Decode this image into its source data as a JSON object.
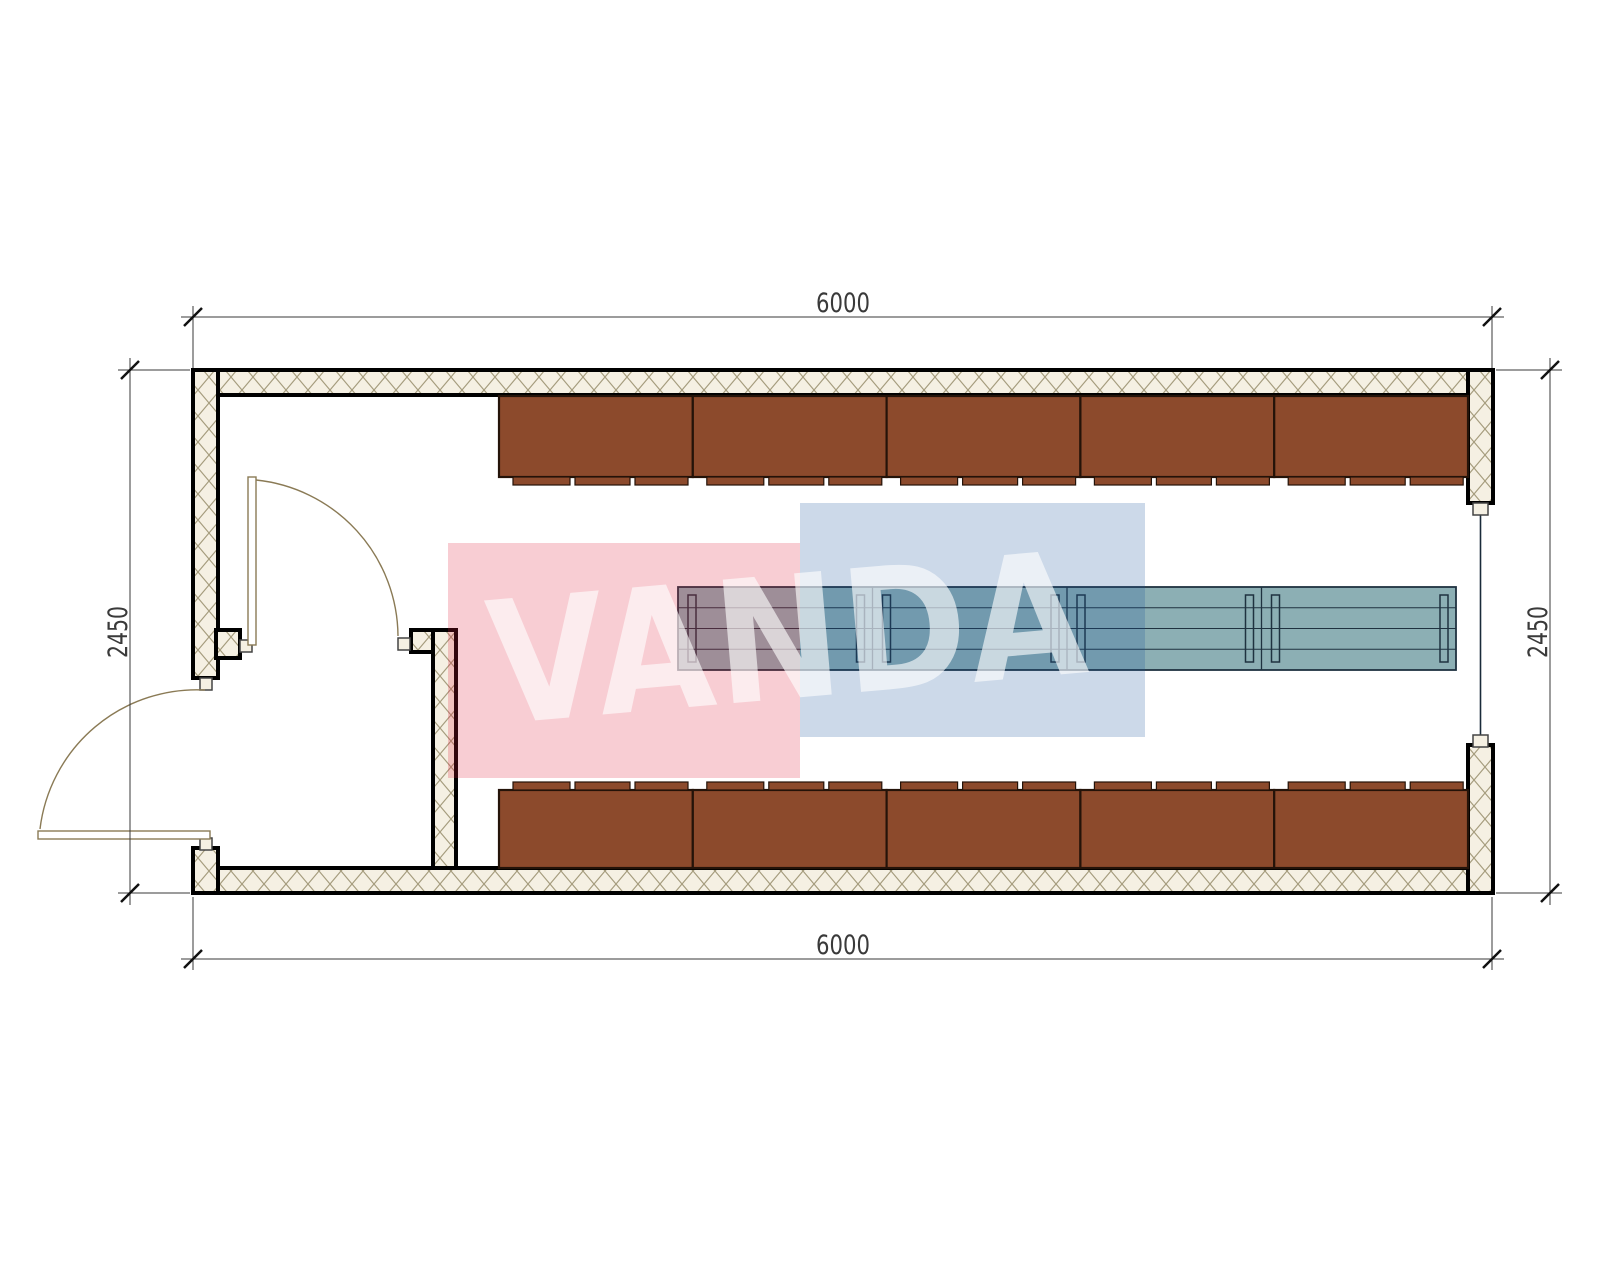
{
  "floor_plan": {
    "dimensions": {
      "top": "6000",
      "bottom": "6000",
      "left": "2450",
      "right": "2450"
    },
    "watermark": {
      "text": "VANDA",
      "red_block_color": "#df1c37",
      "blue_block_color": "#17529b",
      "text_color": "#ffffff"
    },
    "colors": {
      "cabinet_fill": "#8c4a2c",
      "table_fill": "#8cafb4",
      "table_line": "#1f3240",
      "wall_hatch_bg": "#f5f0e3",
      "wall_hatch_line": "#a59c7d",
      "door_line": "#8a7a55",
      "dimension_line": "#3a3a3a",
      "frame_square_fill": "#f5f0e3"
    },
    "counts": {
      "wall_cabinets_top_row": 5,
      "wall_cabinets_bottom_row": 5,
      "table_segments": 4,
      "doors": 2,
      "windows": 1
    }
  }
}
